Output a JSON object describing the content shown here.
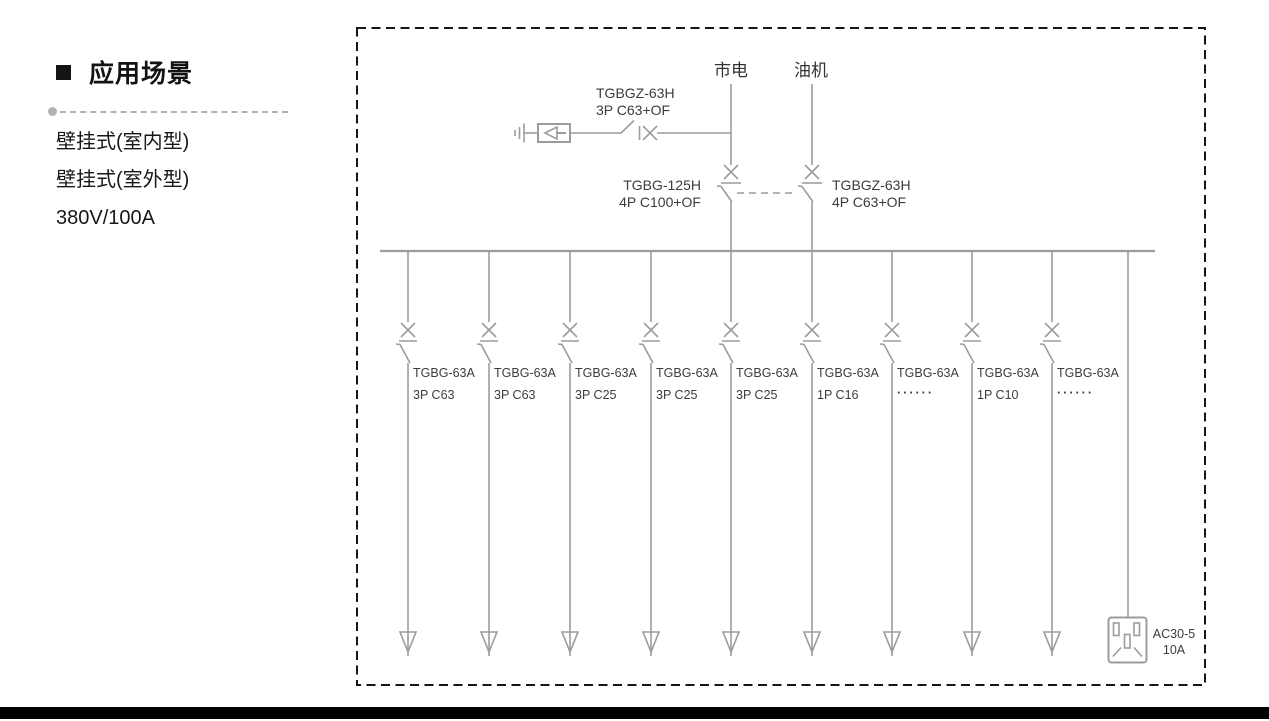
{
  "sidebar": {
    "title": "应用场景",
    "features": [
      "壁挂式(室内型)",
      "壁挂式(室外型)",
      "380V/100A"
    ]
  },
  "diagram": {
    "mains_label": "市电",
    "generator_label": "油机",
    "spd_breaker": {
      "model": "TGBGZ-63H",
      "spec": "3P C63+OF"
    },
    "mains_breaker": {
      "model": "TGBG-125H",
      "spec": "4P C100+OF"
    },
    "generator_breaker": {
      "model": "TGBGZ-63H",
      "spec": "4P C63+OF"
    },
    "feeders": [
      {
        "model": "TGBG-63A",
        "spec": "3P C63"
      },
      {
        "model": "TGBG-63A",
        "spec": "3P C63"
      },
      {
        "model": "TGBG-63A",
        "spec": "3P C25"
      },
      {
        "model": "TGBG-63A",
        "spec": "3P C25"
      },
      {
        "model": "TGBG-63A",
        "spec": "3P C25"
      },
      {
        "model": "TGBG-63A",
        "spec": "1P C16"
      },
      {
        "model": "TGBG-63A",
        "spec": "······"
      },
      {
        "model": "TGBG-63A",
        "spec": "1P C10"
      },
      {
        "model": "TGBG-63A",
        "spec": "······"
      }
    ],
    "socket": {
      "model": "AC30-5",
      "rating": "10A"
    },
    "colors": {
      "line_gray": "#9c9c9c",
      "label_gray": "#3c3c3c",
      "border_black": "#161616",
      "text_black": "#131313"
    }
  }
}
